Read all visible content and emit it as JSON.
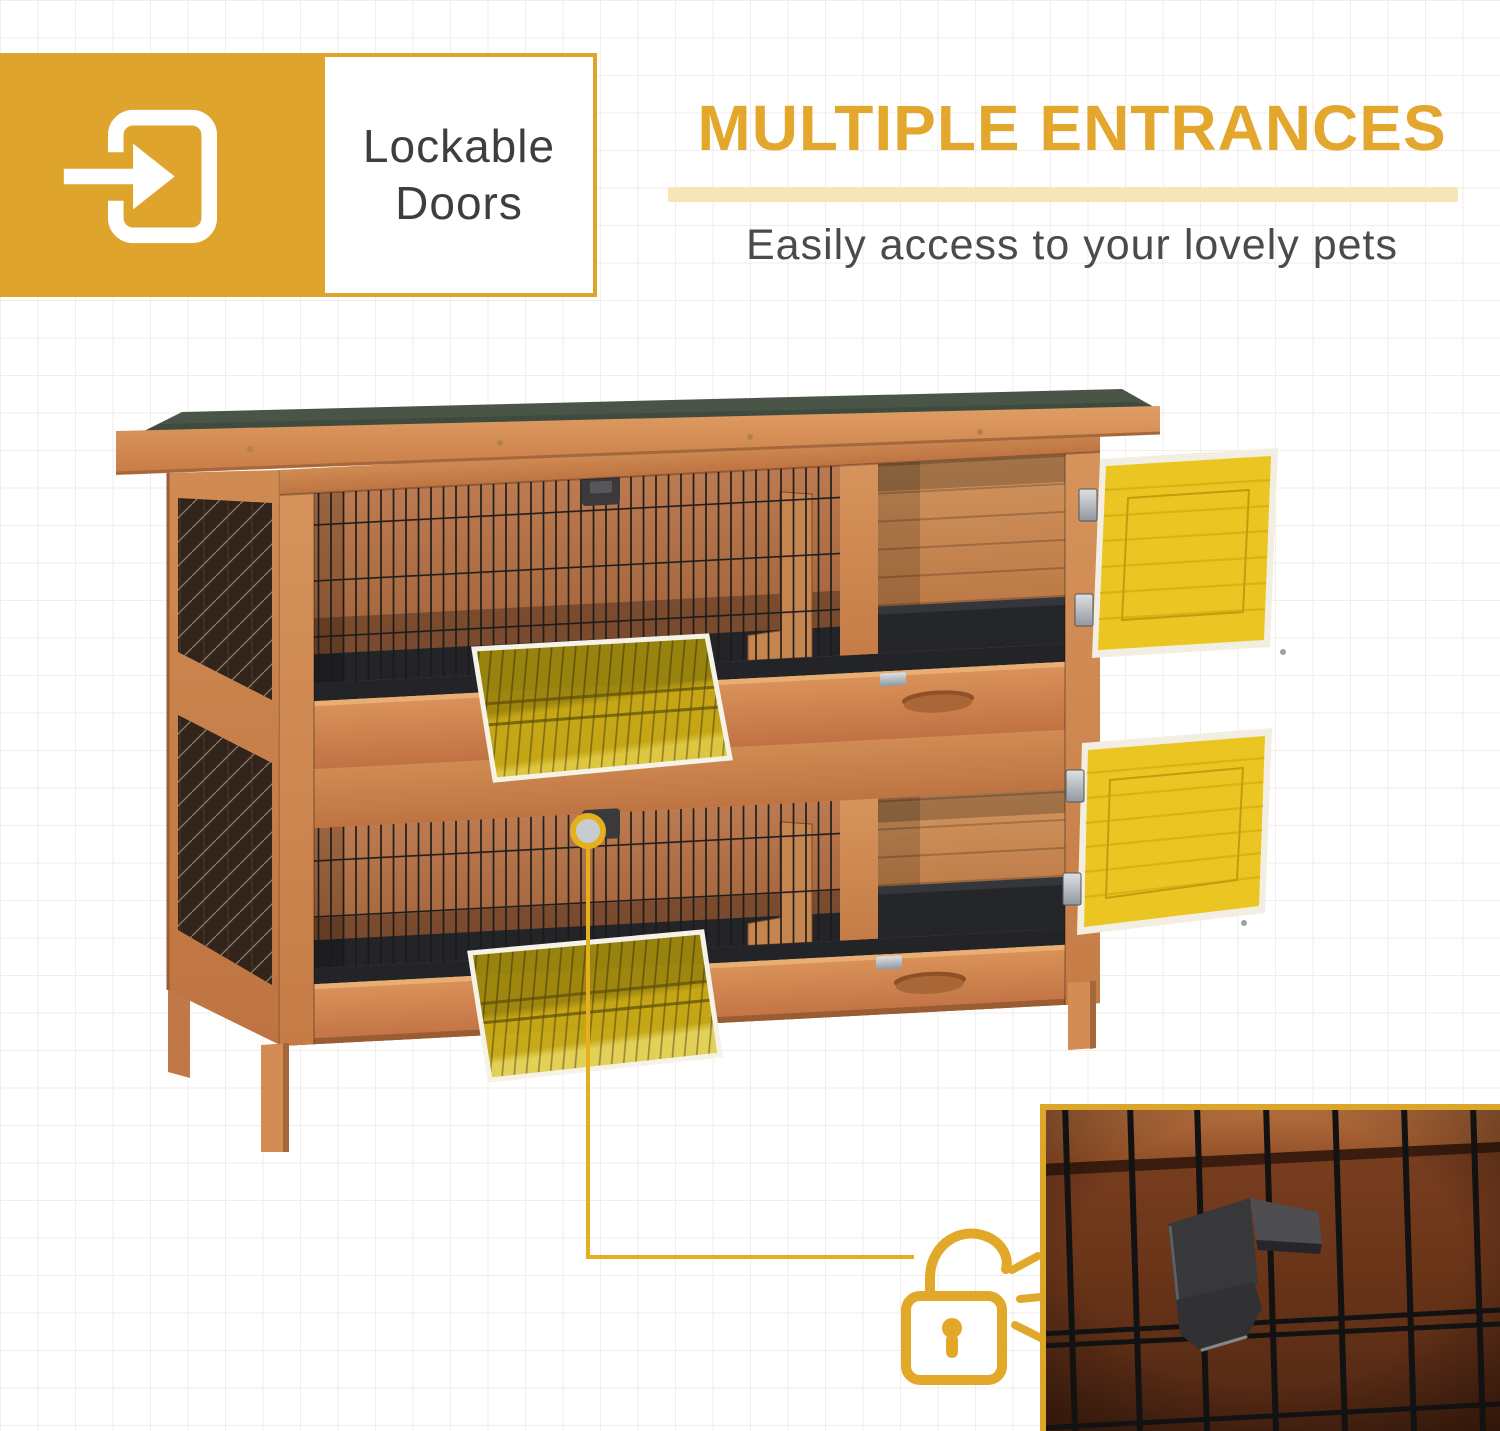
{
  "page": {
    "width": 1500,
    "height": 1431,
    "background": "#FFFFFF",
    "grid_line_color": "#F2EDE9"
  },
  "badge": {
    "icon": "door-enter-arrow-icon",
    "line1": "Lockable",
    "line2": "Doors",
    "box_color": "#DFA42C",
    "text_color": "#3E3E3E"
  },
  "header": {
    "title": "MULTIPLE ENTRANCES",
    "title_color": "#E3A72D",
    "underline_color": "#F7E6B5",
    "subtitle": "Easily access to your lovely pets",
    "subtitle_color": "#4B4B4B"
  },
  "illustration": {
    "subject": "two-tier-wooden-rabbit-hutch",
    "wood_color": "#D28C54",
    "roof_felt_color": "#4A5548",
    "open_door_color": "#EBC522",
    "tray_highlight_color": "#C5A714",
    "mesh_color": "#1A1A1A",
    "callout": {
      "marker_icon": "circle-ring-marker-icon",
      "connector_color": "#E5B01E",
      "lock_icon": "padlock-open-icon"
    },
    "inset": {
      "content": "lock-latch-closeup-photo",
      "border_color": "#DCA62B"
    }
  }
}
